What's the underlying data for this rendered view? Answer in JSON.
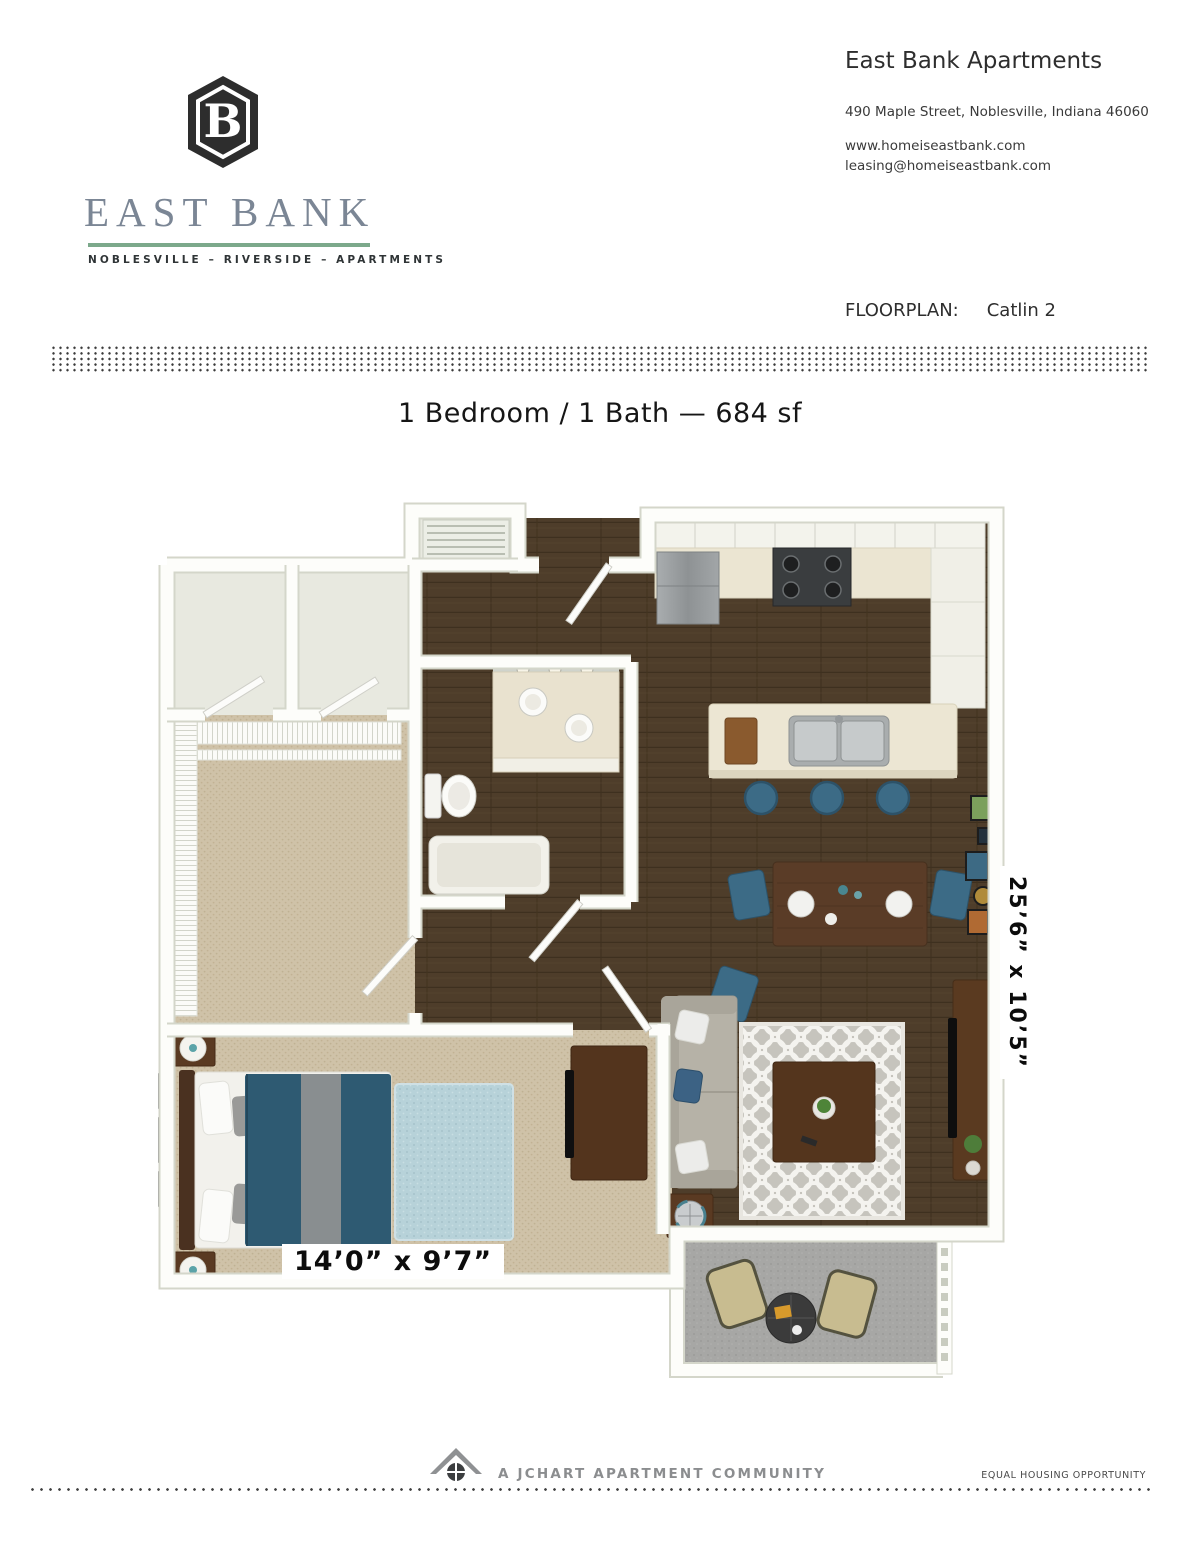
{
  "brand": {
    "monogram": "B",
    "name": "EAST BANK",
    "tagline": "NOBLESVILLE – RIVERSIDE – APARTMENTS",
    "accent_green": "#7ca98b",
    "name_color": "#7b8695"
  },
  "contact": {
    "company": "East Bank Apartments",
    "address": "490 Maple Street, Noblesville, Indiana 46060",
    "website": "www.homeiseastbank.com",
    "email": "leasing@homeiseastbank.com"
  },
  "floorplan_header": {
    "label": "FLOORPLAN:",
    "plan_name": "Catlin 2"
  },
  "summary": {
    "title": "1 Bedroom / 1 Bath — 684 sf"
  },
  "floorplan": {
    "living_dining_dimensions": "25’6” x 10’5”",
    "bedroom_dimensions": "14’0” x 9’7”",
    "colors": {
      "wood_floor": "#4e3d2a",
      "carpet": "#cfc2a8",
      "balcony_floor": "#a7a7a5",
      "bed_duvet_teal": "#2e5a72",
      "chair_blue": "#3c6b86",
      "counter_cream": "#ece6d3"
    }
  },
  "footer": {
    "community": "A JCHART APARTMENT COMMUNITY",
    "equal_housing": "EQUAL HOUSING OPPORTUNITY"
  }
}
